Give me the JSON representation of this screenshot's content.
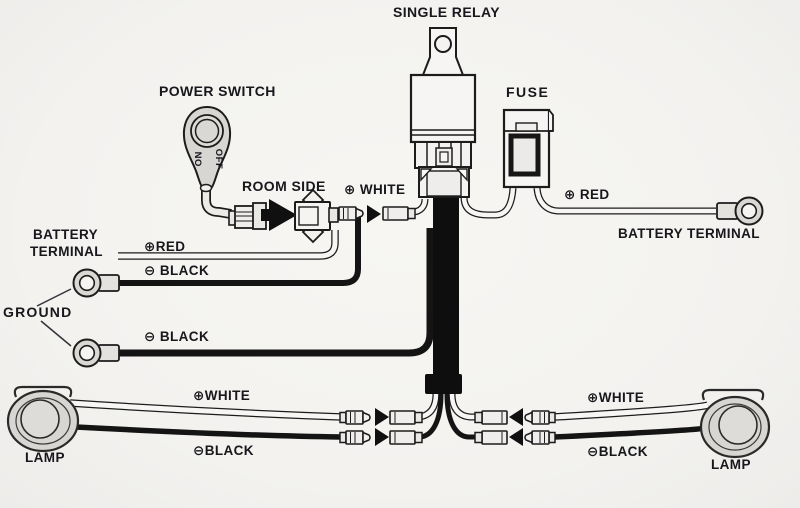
{
  "diagram": {
    "title": "SINGLE RELAY",
    "labels": {
      "single_relay": "SINGLE RELAY",
      "power_switch": "POWER SWITCH",
      "room_side": "ROOM SIDE",
      "fuse": "FUSE",
      "white_top": "⊕ WHITE",
      "battery_left_line1": "BATTERY",
      "battery_left_line2": "TERMINAL",
      "red_left": "⊕RED",
      "black_left": "⊖ BLACK",
      "ground": "GROUND",
      "black_ground2": "⊖ BLACK",
      "red_right": "⊕ RED",
      "battery_right": "BATTERY TERMINAL",
      "white_lamp_left": "⊕WHITE",
      "black_lamp_left": "⊖BLACK",
      "white_lamp_right": "⊕WHITE",
      "black_lamp_right": "⊖BLACK",
      "lamp_left": "LAMP",
      "lamp_right": "LAMP",
      "switch_on": "ON",
      "switch_off": "OFF"
    },
    "colors": {
      "background": "#f3f2ef",
      "ink": "#1c1c1c",
      "wire_black": "#111111",
      "wire_white_core": "#f7f6f4",
      "component_fill": "#f6f5f3",
      "connector_fill": "#efeeec",
      "switch_fill": "#d7d6d3",
      "lamp_fill": "#d7d6d3",
      "label_text": "#17171c"
    }
  }
}
